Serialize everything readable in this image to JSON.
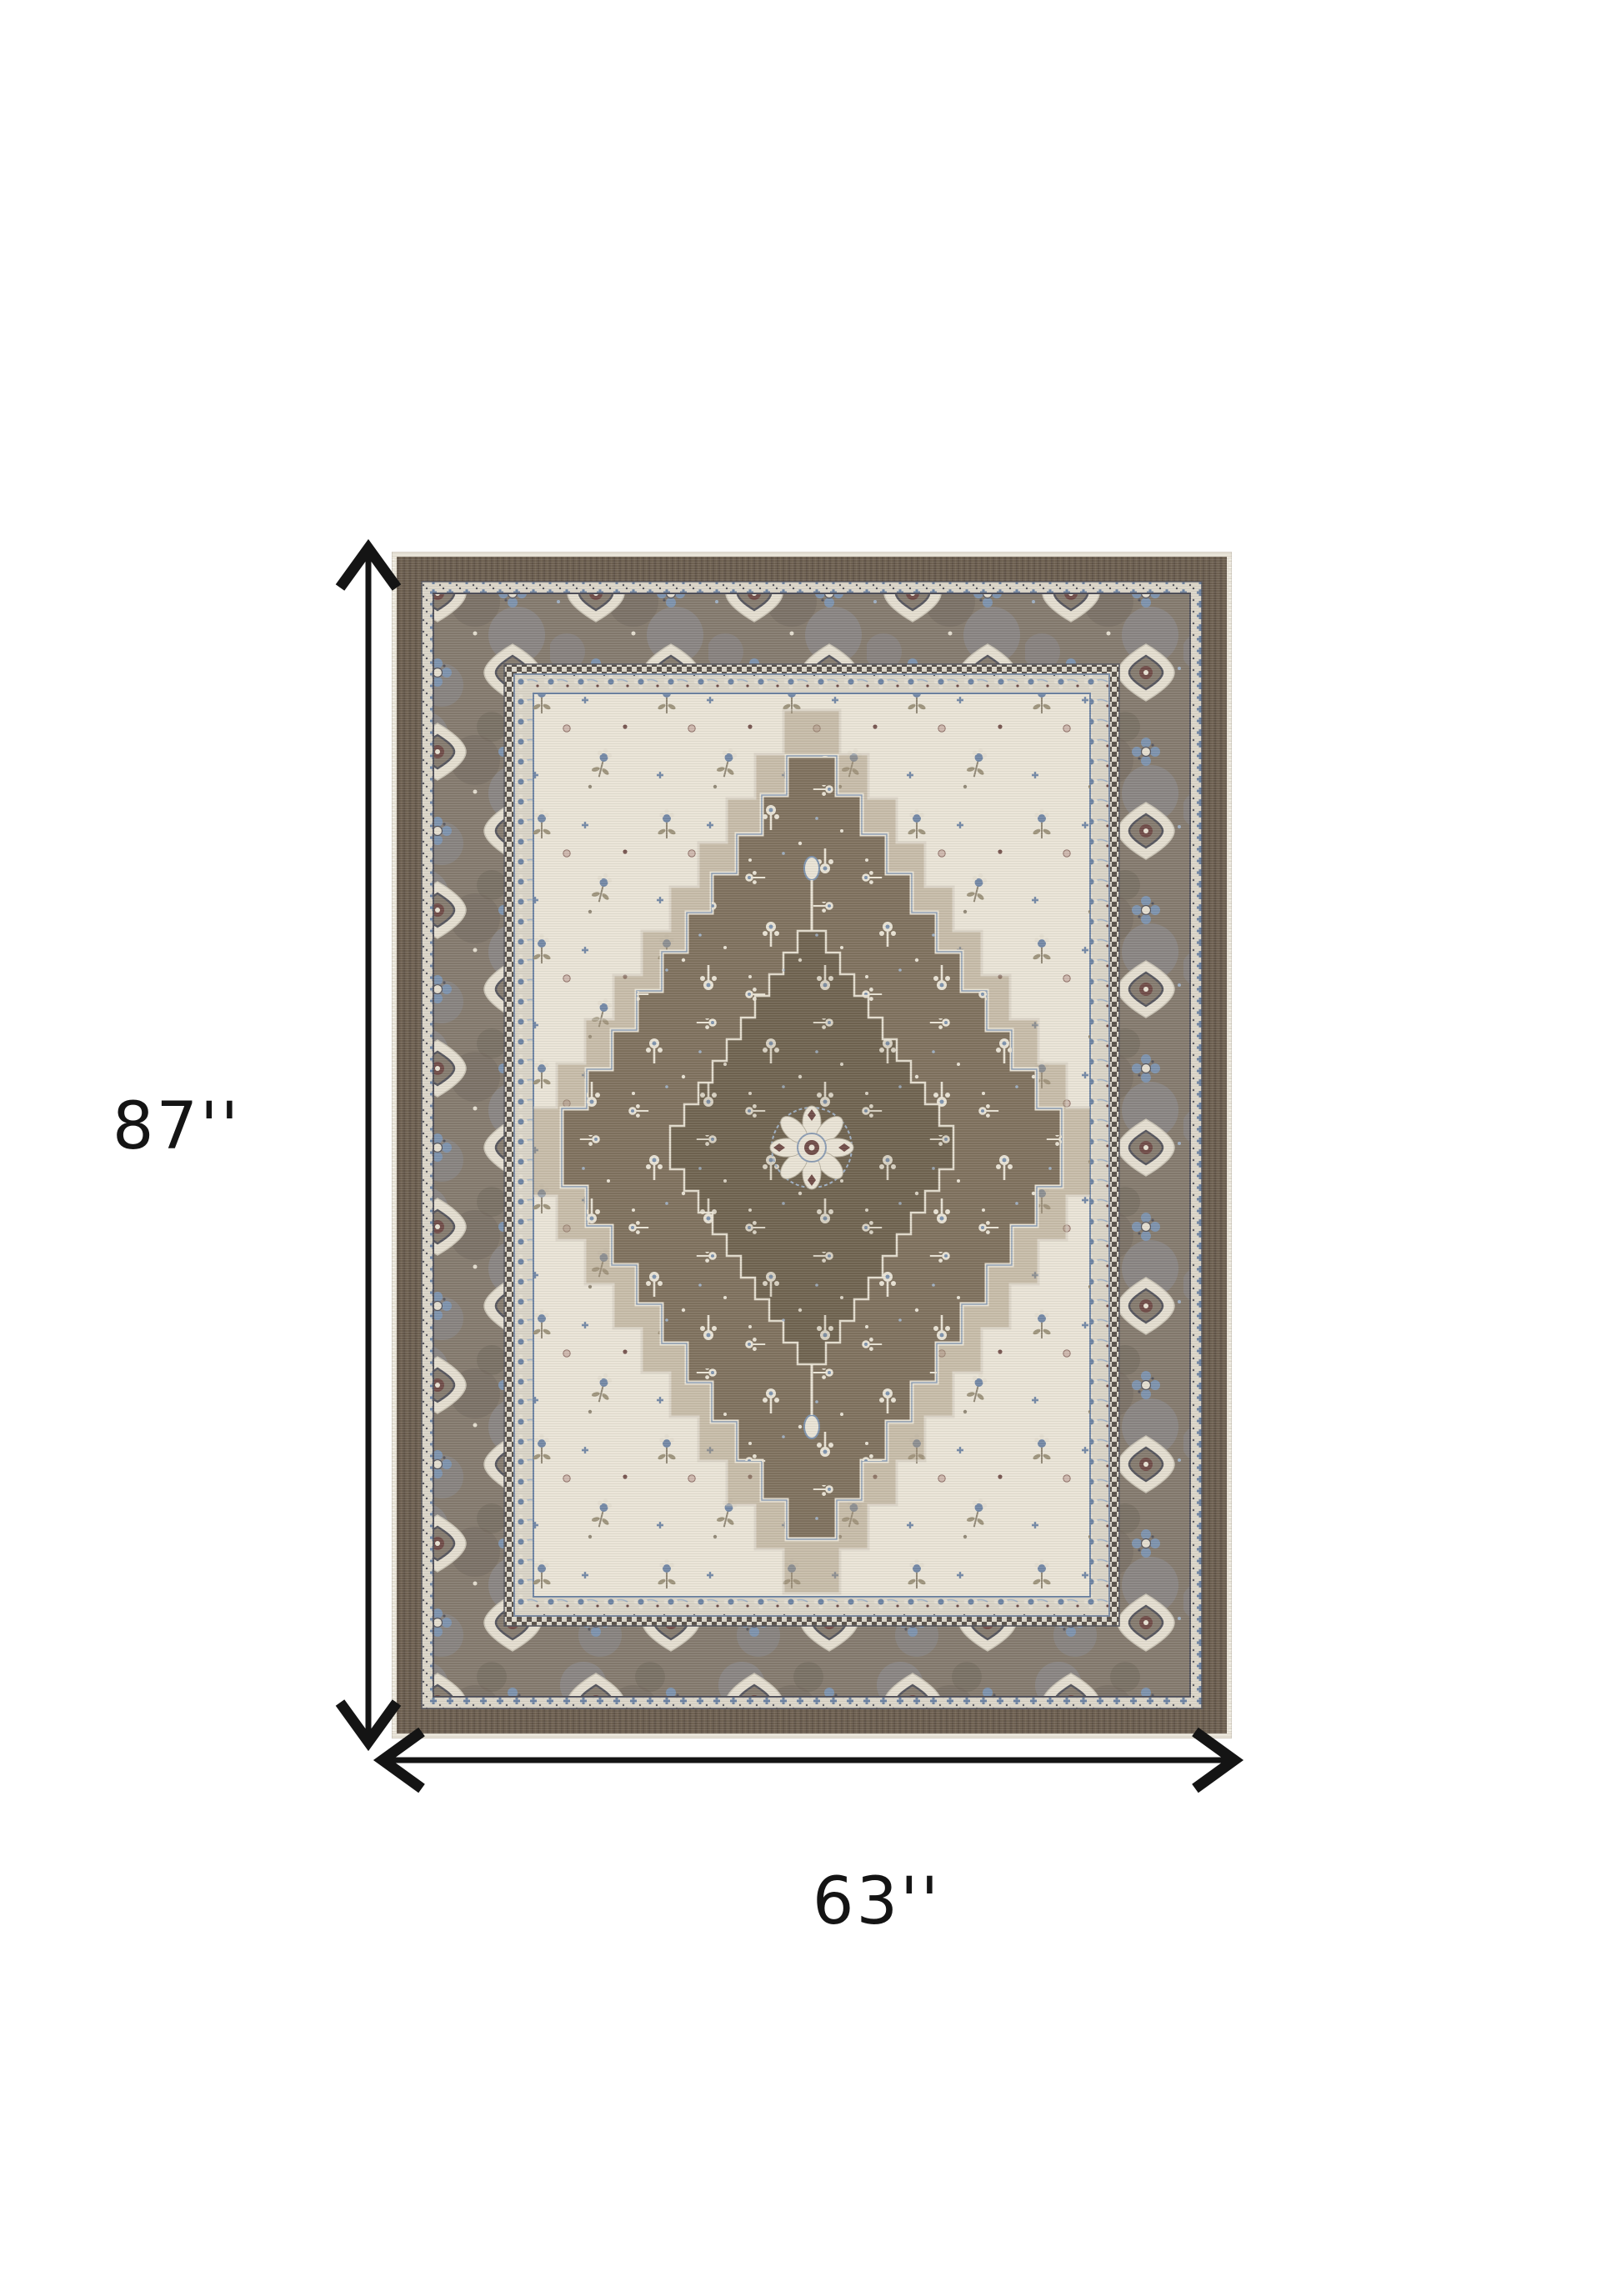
{
  "page": {
    "background_color": "#ffffff"
  },
  "dimensions": {
    "height_label": "87''",
    "width_label": "63''"
  },
  "icons": {
    "vertical_arrow": "double-headed-vertical-dimension-arrow",
    "horizontal_arrow": "double-headed-horizontal-dimension-arrow"
  },
  "colors": {
    "ink": "#141414",
    "page-bg": "#ffffff",
    "rug-edge": "#e9e4d8",
    "band-dark": "#6c5f50",
    "band-dark2": "#615447",
    "band-light": "#7b6c5c",
    "guard-cream": "#dcd6c9",
    "flower-bg": "#d9d4c7",
    "checker-dark": "#57504a",
    "border-ground": "#847a6e",
    "border-ground2": "#8d8d95",
    "border-ground3": "#6e655a",
    "motif-cream": "#e4ded0",
    "motif-edge": "#c9c3b5",
    "motif-dark": "#54545c",
    "motif-maroon": "#6f4b47",
    "blue": "#6d83a3",
    "blue-mid": "#7d92ad",
    "blue-light": "#9fb0c4",
    "field-ivory": "#eae4d7",
    "field-olive": "#8c8371",
    "leaf": "#9a9078",
    "pink": "#cdb6ac",
    "pink-edge": "#8a6a62",
    "med-halo": "#a5957d",
    "med-brown": "#7f715e",
    "med-dark": "#6f6350",
    "rosette-cream": "#e9e3d5"
  }
}
